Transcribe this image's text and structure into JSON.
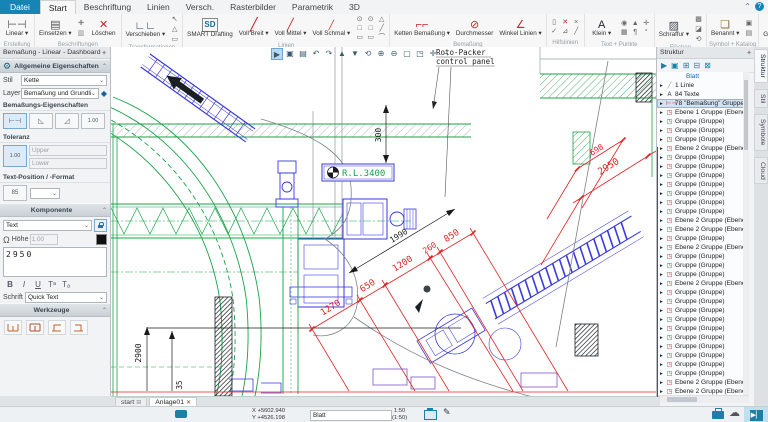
{
  "glyphs": {
    "pin": "✦",
    "gear": "⚙",
    "chev_up": "⌃",
    "dd": "⌄",
    "omega": "Ω",
    "help": "?",
    "home": "⊞",
    "close": "✕",
    "cloud": "☁",
    "pen": "✎",
    "toggle": "▶▏"
  },
  "menu": {
    "file": "Datei",
    "tabs": [
      "Start",
      "Beschriftung",
      "Linien",
      "Versch.",
      "Rasterbilder",
      "Parametrik",
      "3D"
    ],
    "active_tab": "Start"
  },
  "ribbon": {
    "groups": [
      {
        "label": "Erstellung",
        "items": [
          {
            "kind": "big",
            "name": "linear",
            "label": "Linear ▾",
            "glyph": "⊢⊣"
          }
        ]
      },
      {
        "label": "Beschriftungen",
        "items": [
          {
            "kind": "big",
            "name": "einsetzen",
            "label": "Einsetzen ▾",
            "glyph": "▤"
          },
          {
            "kind": "col",
            "glyphs": [
              {
                "n": "beschriftung-plus",
                "g": "✚",
                "c": "#888"
              },
              {
                "n": "beschriftung-liste",
                "g": "▥",
                "c": "#888"
              }
            ]
          },
          {
            "kind": "big",
            "name": "loeschen",
            "label": "Löschen",
            "glyph": "✕",
            "color": "#cc2222"
          }
        ]
      },
      {
        "label": "Transformationen",
        "items": [
          {
            "kind": "big",
            "name": "verschieben",
            "label": "Verschieben ▾",
            "glyph": "∟∟",
            "color": "#2a3a55"
          },
          {
            "kind": "col",
            "glyphs": [
              {
                "n": "transform-pfeil",
                "g": "↖"
              },
              {
                "n": "transform-dreieck",
                "g": "△"
              },
              {
                "n": "transform-rechteck",
                "g": "▭"
              }
            ]
          }
        ]
      },
      {
        "label": "Linien",
        "items": [
          {
            "kind": "big",
            "name": "smart-drafting",
            "label": "SMART Drafting",
            "glyph": "SD",
            "cls": "sd"
          },
          {
            "kind": "big",
            "name": "voll-breit",
            "label": "Voll Breit ▾",
            "glyph": "╱",
            "cls": "thick"
          },
          {
            "kind": "big",
            "name": "voll-mittel",
            "label": "Voll Mittel ▾",
            "glyph": "╱",
            "cls": "med"
          },
          {
            "kind": "big",
            "name": "voll-schmal",
            "label": "Voll Schmal ▾",
            "glyph": "╱",
            "cls": "thin"
          },
          {
            "kind": "grid",
            "glyphs": [
              {
                "n": "kreis",
                "g": "⊙"
              },
              {
                "n": "kreis-2",
                "g": "⊙"
              },
              {
                "n": "bogen",
                "g": "△"
              },
              {
                "n": "rechteck",
                "g": "□"
              },
              {
                "n": "rechteck-2",
                "g": "□"
              },
              {
                "n": "linie",
                "g": "╱"
              },
              {
                "n": "polylinie",
                "g": "▭"
              },
              {
                "n": "polylinie-2",
                "g": "▭"
              },
              {
                "n": "kurve",
                "g": "⌒"
              }
            ]
          }
        ]
      },
      {
        "label": "Bemaßung",
        "items": [
          {
            "kind": "big",
            "name": "ketten-bemassung",
            "label": "Ketten Bemaßung ▾",
            "glyph": "⌐⌐",
            "color": "#cc2222"
          },
          {
            "kind": "big",
            "name": "durchmesser",
            "label": "Durchmesser",
            "glyph": "⊘",
            "color": "#cc2222"
          },
          {
            "kind": "big",
            "name": "winkel-linien",
            "label": "Winkel Linien ▾",
            "glyph": "∠",
            "color": "#cc2222"
          }
        ]
      },
      {
        "label": "Hilfslinien",
        "items": [
          {
            "kind": "grid",
            "glyphs": [
              {
                "n": "hilfslinie-v",
                "g": "▯"
              },
              {
                "n": "hilfslinie-loeschen",
                "g": "✕",
                "c": "#cc2222"
              },
              {
                "n": "hilfslinie-kreuz",
                "g": "×"
              },
              {
                "n": "hilfslinie-ok",
                "g": "✓"
              },
              {
                "n": "hilfslinie-winkel",
                "g": "⊿"
              },
              {
                "n": "hilfslinie-diag",
                "g": "╱"
              }
            ]
          }
        ]
      },
      {
        "label": "Text + Punkte",
        "items": [
          {
            "kind": "big",
            "name": "klein",
            "label": "Klein ▾",
            "glyph": "A",
            "color": "#223"
          },
          {
            "kind": "grid",
            "glyphs": [
              {
                "n": "punkt-kreis",
                "g": "◉"
              },
              {
                "n": "punkt-dreieck",
                "g": "▲"
              },
              {
                "n": "punkt-kreuz",
                "g": "✛"
              },
              {
                "n": "raster",
                "g": "▦"
              },
              {
                "n": "absatz",
                "g": "¶"
              },
              {
                "n": "grad",
                "g": "°"
              }
            ]
          }
        ]
      },
      {
        "label": "Flächen",
        "items": [
          {
            "kind": "big",
            "name": "schraffur",
            "label": "Schraffur ▾",
            "glyph": "▨",
            "color": "#445"
          },
          {
            "kind": "col",
            "glyphs": [
              {
                "n": "flaeche-voll",
                "g": "▩"
              },
              {
                "n": "flaeche-teil",
                "g": "◪"
              },
              {
                "n": "flaeche-update",
                "g": "⟲"
              }
            ]
          }
        ]
      },
      {
        "label": "Symbol + Katalog",
        "items": [
          {
            "kind": "big",
            "name": "benannt",
            "label": "Benannt ▾",
            "glyph": "❏",
            "color": "#8a6d3b"
          },
          {
            "kind": "col",
            "glyphs": [
              {
                "n": "symbol-speichern",
                "g": "▣"
              },
              {
                "n": "katalog",
                "g": "▤"
              }
            ]
          }
        ]
      },
      {
        "label": "Gruppen",
        "items": [
          {
            "kind": "big",
            "name": "gruppe-selektiert",
            "label": "Gruppe Selektiert",
            "glyph": "❖",
            "color": "#334"
          },
          {
            "kind": "col",
            "glyphs": [
              {
                "n": "gruppe-neu",
                "g": "◆",
                "c": "#8a2430"
              },
              {
                "n": "gruppe-aufloesen",
                "g": "◆",
                "c": "#8a2430"
              },
              {
                "n": "gruppe-edit",
                "g": "◆",
                "c": "#8a2430"
              }
            ]
          }
        ]
      }
    ]
  },
  "dashboard": {
    "title": "Bemaßung - Linear - Dashboard",
    "allgemein": {
      "header": "Allgemeine Eigenschaften",
      "stil_label": "Stil",
      "stil_value": "Kette",
      "layer_label": "Layer",
      "layer_value": "Bemaßung und Grundlinie"
    },
    "bem_eig": {
      "header": "Bemaßungs-Eigenschaften",
      "btn4_label": "1.00"
    },
    "toleranz": {
      "header": "Toleranz",
      "btn_label": "1.00",
      "upper": "Upper",
      "lower": "Lower"
    },
    "textpos": {
      "header": "Text-Position / -Format",
      "btn_label": "85"
    },
    "komponente": {
      "header": "Komponente",
      "type_value": "Text",
      "hoehe_label": "Höhe",
      "hoehe_value": "1.00",
      "text_value": "2950",
      "fmt": [
        "B",
        "I",
        "U",
        "Tᵃ",
        "Tₐ"
      ],
      "schrift_label": "Schrift",
      "schrift_value": "Quick Text"
    },
    "werkzeuge": {
      "header": "Werkzeuge"
    }
  },
  "canvas": {
    "toolbar": [
      {
        "name": "select-tool",
        "glyph": "▶"
      },
      {
        "name": "save-view",
        "glyph": "▣"
      },
      {
        "name": "copy-view",
        "glyph": "▤"
      },
      {
        "name": "undo",
        "glyph": "↶"
      },
      {
        "name": "redo",
        "glyph": "↷"
      },
      {
        "name": "up",
        "glyph": "▲"
      },
      {
        "name": "down",
        "glyph": "▼"
      },
      {
        "name": "refresh",
        "glyph": "⟲"
      },
      {
        "name": "zoom-in",
        "glyph": "⊕"
      },
      {
        "name": "zoom-out",
        "glyph": "⊖"
      },
      {
        "name": "zoom-window",
        "glyph": "▢"
      },
      {
        "name": "zoom-fit",
        "glyph": "◳"
      },
      {
        "name": "pan",
        "glyph": "✛"
      },
      {
        "name": "corner",
        "glyph": "¬"
      }
    ],
    "labels": {
      "rl": "R.L.3400",
      "roto1": "Roto-Packer",
      "roto2": "control panel"
    },
    "dims": [
      {
        "name": "dim-300",
        "text": "300",
        "x": 270,
        "y": 88,
        "rot": -90,
        "color": "#1a1a1a",
        "fs": 8
      },
      {
        "name": "dim-1990",
        "text": "1990",
        "x": 289,
        "y": 191,
        "rot": -32,
        "color": "#1a1a1a",
        "fs": 8
      },
      {
        "name": "dim-1270",
        "text": "1270",
        "x": 221,
        "y": 263,
        "rot": -32,
        "color": "#e62222",
        "fs": 9
      },
      {
        "name": "dim-650",
        "text": "650",
        "x": 258,
        "y": 241,
        "rot": -32,
        "color": "#e62222",
        "fs": 9
      },
      {
        "name": "dim-1200",
        "text": "1200",
        "x": 293,
        "y": 219,
        "rot": -32,
        "color": "#e62222",
        "fs": 9
      },
      {
        "name": "dim-260",
        "text": "260",
        "x": 320,
        "y": 203,
        "rot": -32,
        "color": "#e62222",
        "fs": 8
      },
      {
        "name": "dim-850",
        "text": "850",
        "x": 342,
        "y": 191,
        "rot": -32,
        "color": "#e62222",
        "fs": 9
      },
      {
        "name": "dim-698",
        "text": "698",
        "x": 487,
        "y": 105,
        "rot": -32,
        "color": "#e62222",
        "fs": 8
      },
      {
        "name": "dim-2950",
        "text": "2950",
        "x": 499,
        "y": 122,
        "rot": -32,
        "color": "#e62222",
        "fs": 9.5
      },
      {
        "name": "dim-2900",
        "text": "2900",
        "x": 30,
        "y": 306,
        "rot": -90,
        "color": "#1a1a1a",
        "fs": 8
      },
      {
        "name": "dim-35",
        "text": "35",
        "x": 71,
        "y": 338,
        "rot": -90,
        "color": "#1a1a1a",
        "fs": 7.5
      }
    ]
  },
  "structure": {
    "title": "Struktur",
    "toolbar": [
      {
        "name": "pick",
        "glyph": "▶"
      },
      {
        "name": "copy",
        "glyph": "▣"
      },
      {
        "name": "expand-all",
        "glyph": "⊞"
      },
      {
        "name": "collapse-branch",
        "glyph": "⊟"
      },
      {
        "name": "collapse-all",
        "glyph": "⊠"
      }
    ],
    "items": [
      {
        "type": "root",
        "label": "Blatt"
      },
      {
        "type": "line",
        "label": "1 Linie"
      },
      {
        "type": "text",
        "label": "84 Texte"
      },
      {
        "type": "dims",
        "label": "78 \"Bemaßung\" Gruppen",
        "selected": true
      },
      {
        "type": "group",
        "label": "Ebene 1 Gruppe (Ebene 1 Gruppe)"
      },
      {
        "type": "group",
        "label": "Gruppe (Gruppe)"
      },
      {
        "type": "group",
        "label": "Gruppe (Gruppe)"
      },
      {
        "type": "group",
        "label": "Gruppe (Gruppe)"
      },
      {
        "type": "group",
        "label": "Ebene 2 Gruppe (Ebene 2 Gruppe)"
      },
      {
        "type": "group",
        "label": "Gruppe (Gruppe)"
      },
      {
        "type": "group",
        "label": "Gruppe (Gruppe)"
      },
      {
        "type": "group",
        "label": "Gruppe (Gruppe)"
      },
      {
        "type": "group",
        "label": "Gruppe (Gruppe)"
      },
      {
        "type": "group",
        "label": "Gruppe (Gruppe)"
      },
      {
        "type": "group",
        "label": "Gruppe (Gruppe)"
      },
      {
        "type": "group",
        "label": "Gruppe (Gruppe)"
      },
      {
        "type": "group",
        "label": "Ebene 2 Gruppe (Ebene 2 Gruppe)"
      },
      {
        "type": "group",
        "label": "Ebene 2 Gruppe (Ebene 2 Gruppe)"
      },
      {
        "type": "group",
        "label": "Gruppe (Gruppe)"
      },
      {
        "type": "group",
        "label": "Ebene 2 Gruppe (Ebene 2 Gruppe)"
      },
      {
        "type": "group",
        "label": "Gruppe (Gruppe)"
      },
      {
        "type": "group",
        "label": "Gruppe (Gruppe)"
      },
      {
        "type": "group",
        "label": "Gruppe (Gruppe)"
      },
      {
        "type": "group",
        "label": "Ebene 2 Gruppe (Ebene 2 Gruppe)"
      },
      {
        "type": "group",
        "label": "Gruppe (Gruppe)"
      },
      {
        "type": "group",
        "label": "Gruppe (Gruppe)"
      },
      {
        "type": "group",
        "label": "Gruppe (Gruppe)"
      },
      {
        "type": "group",
        "label": "Gruppe (Gruppe)"
      },
      {
        "type": "group",
        "label": "Gruppe (Gruppe)"
      },
      {
        "type": "group",
        "label": "Gruppe (Gruppe)"
      },
      {
        "type": "group",
        "label": "Gruppe (Gruppe)"
      },
      {
        "type": "group",
        "label": "Gruppe (Gruppe)"
      },
      {
        "type": "group",
        "label": "Gruppe (Gruppe)"
      },
      {
        "type": "group",
        "label": "Gruppe (Gruppe)"
      },
      {
        "type": "group",
        "label": "Ebene 2 Gruppe (Ebene 2 Gruppe)"
      },
      {
        "type": "group",
        "label": "Ebene 2 Gruppe (Ebene 2 Gruppe)"
      }
    ],
    "side_tabs": [
      "Struktur",
      "Stil",
      "Symbole",
      "Cloud"
    ]
  },
  "bottom": {
    "doc_tabs": {
      "start_label": "start",
      "anlage_label": "Anlage01"
    },
    "status": {
      "x": "X +5602.940",
      "y": "Y +4526.198",
      "field_value": "Blatt",
      "scale": "1:50",
      "scale2": "(1:50)"
    }
  }
}
